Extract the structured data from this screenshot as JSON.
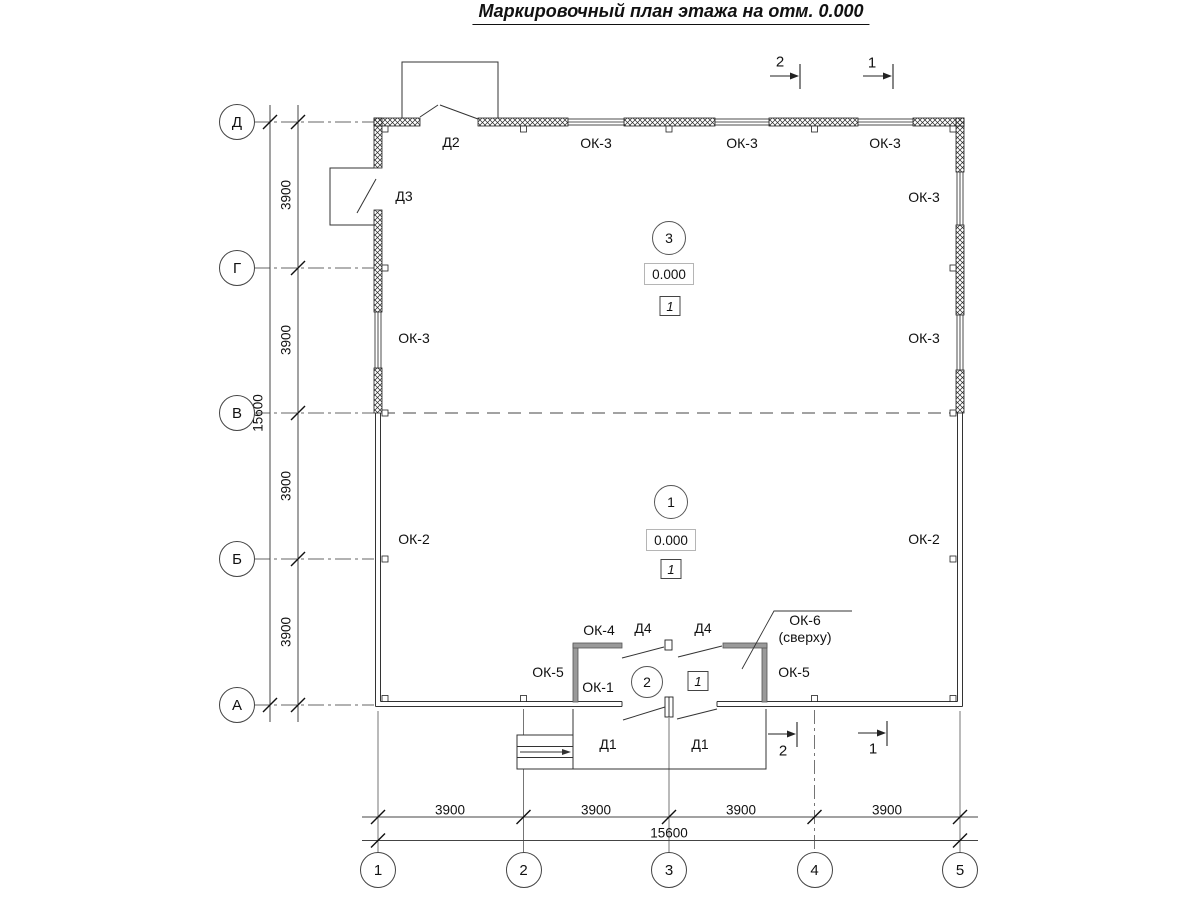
{
  "title": "Маркировочный план этажа на отм. 0.000",
  "grid": {
    "rows": [
      {
        "label": "Д",
        "y": 122
      },
      {
        "label": "Г",
        "y": 268
      },
      {
        "label": "В",
        "y": 413
      },
      {
        "label": "Б",
        "y": 559
      },
      {
        "label": "А",
        "y": 705
      }
    ],
    "cols": [
      {
        "label": "1",
        "x": 378
      },
      {
        "label": "2",
        "x": 523.5
      },
      {
        "label": "3",
        "x": 669
      },
      {
        "label": "4",
        "x": 814.5
      },
      {
        "label": "5",
        "x": 960
      }
    ]
  },
  "rooms": [
    {
      "number": "3",
      "circle": {
        "x": 669,
        "y": 238,
        "r": 16
      },
      "elevation": "0.000",
      "elev_pos": {
        "x": 669,
        "y": 274
      },
      "floor": "1",
      "floor_pos": {
        "x": 670,
        "y": 306
      }
    },
    {
      "number": "1",
      "circle": {
        "x": 671,
        "y": 502,
        "r": 16
      },
      "elevation": "0.000",
      "elev_pos": {
        "x": 671,
        "y": 540
      },
      "floor": "1",
      "floor_pos": {
        "x": 671,
        "y": 569
      }
    },
    {
      "number": "2",
      "circle": {
        "x": 647,
        "y": 682,
        "r": 15
      },
      "floor": "1",
      "floor_pos": {
        "x": 698,
        "y": 681
      }
    }
  ],
  "labels": [
    {
      "name": "dimension-label",
      "kind": "dim rot",
      "text": "3900",
      "x": 286,
      "y": 195
    },
    {
      "name": "dimension-label",
      "kind": "dim rot",
      "text": "3900",
      "x": 286,
      "y": 340
    },
    {
      "name": "dimension-label",
      "kind": "dim rot",
      "text": "3900",
      "x": 286,
      "y": 486
    },
    {
      "name": "dimension-label",
      "kind": "dim rot",
      "text": "3900",
      "x": 286,
      "y": 632
    },
    {
      "name": "dimension-label",
      "kind": "dim rot",
      "text": "15600",
      "x": 258,
      "y": 413
    },
    {
      "name": "dimension-label",
      "kind": "dim",
      "text": "3900",
      "x": 450,
      "y": 810
    },
    {
      "name": "dimension-label",
      "kind": "dim",
      "text": "3900",
      "x": 596,
      "y": 810
    },
    {
      "name": "dimension-label",
      "kind": "dim",
      "text": "3900",
      "x": 741,
      "y": 810
    },
    {
      "name": "dimension-label",
      "kind": "dim",
      "text": "3900",
      "x": 887,
      "y": 810
    },
    {
      "name": "dimension-label",
      "kind": "dim",
      "text": "15600",
      "x": 669,
      "y": 833
    },
    {
      "name": "window-mark",
      "text": "ОК-3",
      "x": 596,
      "y": 143
    },
    {
      "name": "window-mark",
      "text": "ОК-3",
      "x": 742,
      "y": 143
    },
    {
      "name": "window-mark",
      "text": "ОК-3",
      "x": 885,
      "y": 143
    },
    {
      "name": "window-mark",
      "text": "ОК-3",
      "x": 924,
      "y": 197
    },
    {
      "name": "window-mark",
      "text": "ОК-3",
      "x": 414,
      "y": 338
    },
    {
      "name": "window-mark",
      "text": "ОК-3",
      "x": 924,
      "y": 338
    },
    {
      "name": "window-mark",
      "text": "ОК-2",
      "x": 414,
      "y": 539
    },
    {
      "name": "window-mark",
      "text": "ОК-2",
      "x": 924,
      "y": 539
    },
    {
      "name": "window-mark",
      "text": "ОК-4",
      "x": 599,
      "y": 630
    },
    {
      "name": "window-mark",
      "text": "ОК-5",
      "x": 548,
      "y": 672
    },
    {
      "name": "window-mark",
      "text": "ОК-5",
      "x": 794,
      "y": 672
    },
    {
      "name": "window-mark",
      "text": "ОК-1",
      "x": 598,
      "y": 687
    },
    {
      "name": "window-mark",
      "text": "ОК-6",
      "x": 805,
      "y": 620
    },
    {
      "name": "window-mark-note",
      "text": "(сверху)",
      "x": 805,
      "y": 637
    },
    {
      "name": "door-mark",
      "text": "Д2",
      "x": 451,
      "y": 142
    },
    {
      "name": "door-mark",
      "text": "Д3",
      "x": 404,
      "y": 196
    },
    {
      "name": "door-mark",
      "text": "Д4",
      "x": 643,
      "y": 628
    },
    {
      "name": "door-mark",
      "text": "Д4",
      "x": 703,
      "y": 628
    },
    {
      "name": "door-mark",
      "text": "Д1",
      "x": 608,
      "y": 744
    },
    {
      "name": "door-mark",
      "text": "Д1",
      "x": 700,
      "y": 744
    },
    {
      "name": "section-mark",
      "kind": "sec",
      "text": "2",
      "x": 780,
      "y": 62
    },
    {
      "name": "section-mark",
      "kind": "sec",
      "text": "1",
      "x": 872,
      "y": 63
    },
    {
      "name": "section-mark",
      "kind": "sec",
      "text": "2",
      "x": 783,
      "y": 751
    },
    {
      "name": "section-mark",
      "kind": "sec",
      "text": "1",
      "x": 873,
      "y": 749
    }
  ]
}
